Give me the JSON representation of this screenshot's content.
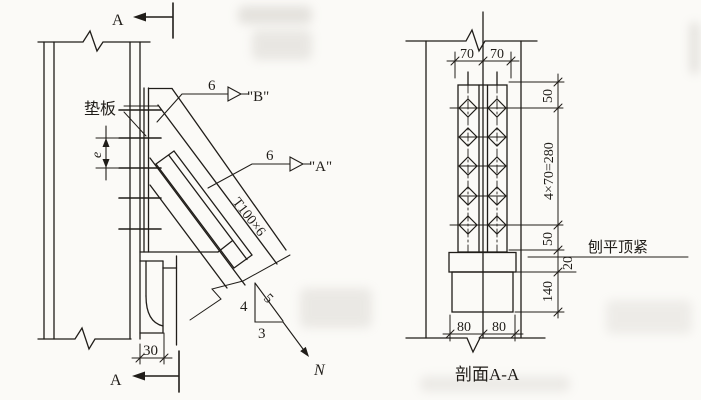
{
  "figure": {
    "type": "steel bracing connection detail drawing",
    "elevation": {
      "cut_label_top": "A",
      "cut_label_bottom": "A",
      "pad_plate": "垫板",
      "eccentricity": "e",
      "offset_dim": "30",
      "weld_b": {
        "size": "6",
        "ref": "\"B\""
      },
      "weld_a": {
        "size": "6",
        "ref": "\"A\""
      },
      "member": "T100×6",
      "slope": {
        "rise": "4",
        "hypotenuse": "5",
        "run": "3"
      },
      "force": "N"
    },
    "section": {
      "caption": "剖面A-A",
      "note": "刨平顶紧",
      "dims": {
        "gauge_left": "70",
        "gauge_right": "70",
        "edge_top": "50",
        "pitch": "4×70=280",
        "edge_bottom": "50",
        "plate_thickness": "20",
        "seat_height": "140",
        "base_left": "80",
        "base_right": "80"
      },
      "bolt_rows": 5,
      "bolt_columns": 2
    },
    "colors": {
      "ink": "#201d19",
      "paper": "#fbfaf7"
    }
  }
}
